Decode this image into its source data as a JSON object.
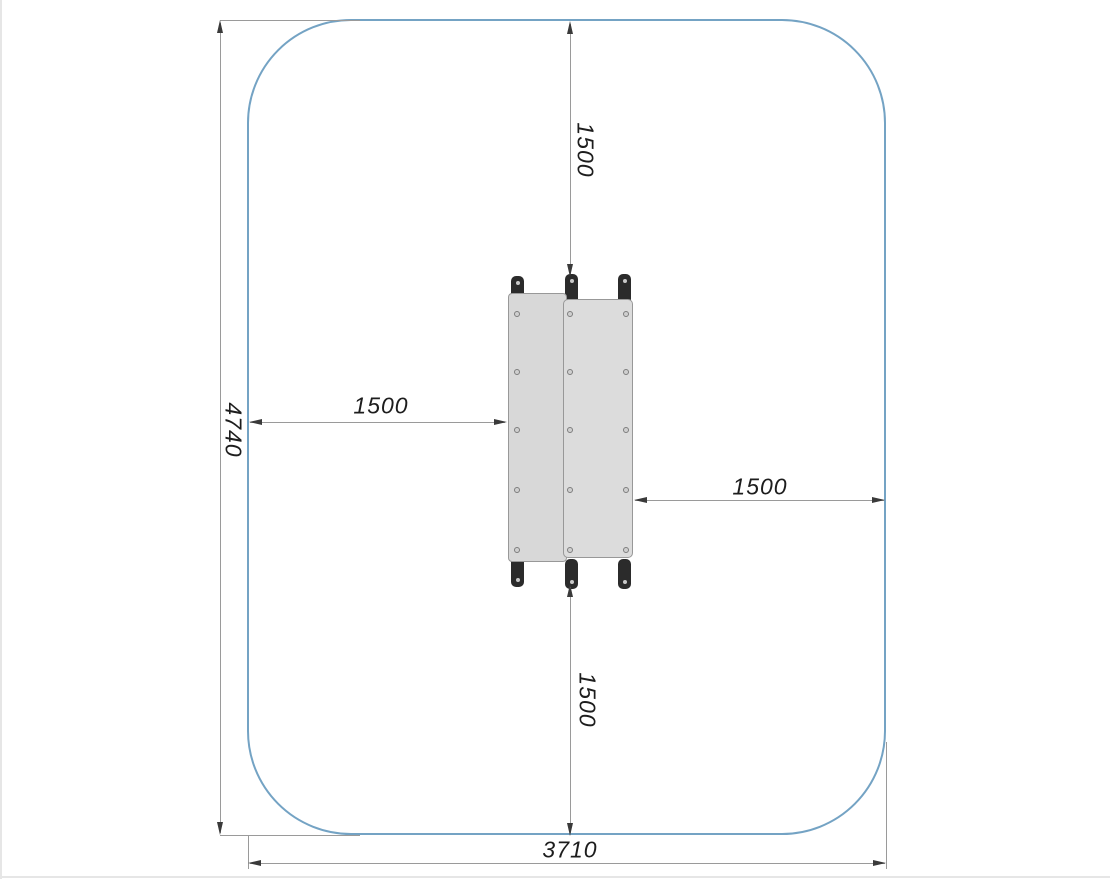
{
  "dimensions": {
    "clearance_top": "1500",
    "clearance_bottom": "1500",
    "clearance_left": "1500",
    "clearance_right": "1500",
    "zone_length": "4740",
    "zone_width": "3710"
  },
  "colors": {
    "zone_boundary": "#74A3C4",
    "dimension_line": "#9A9A9A",
    "arrow": "#3A3A3A",
    "label_text": "#1D1D1D",
    "panel_fill": "#D8D8D8",
    "panel_border": "#989898",
    "foot_fill": "#2B2B2B"
  }
}
